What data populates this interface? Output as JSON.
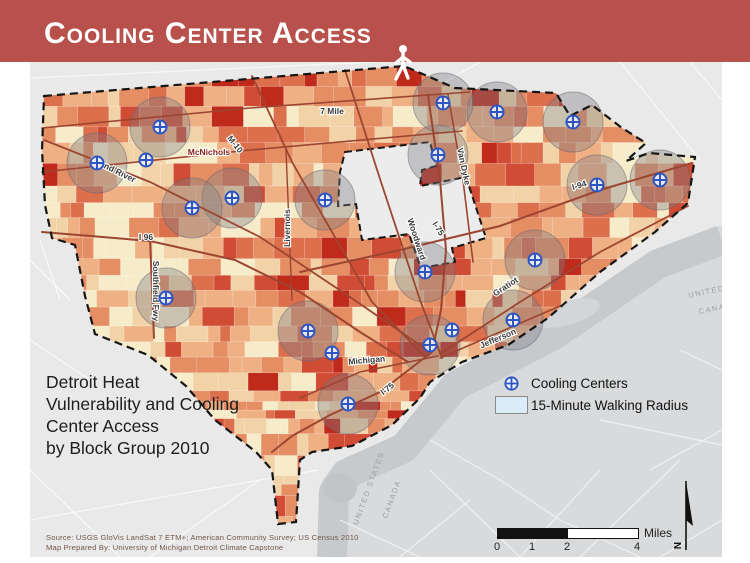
{
  "slide": {
    "title": "Cooling Center Access"
  },
  "map": {
    "title_lines": [
      "Detroit Heat",
      "Vulnerability and Cooling",
      "Center Access",
      "by Block Group 2010"
    ],
    "source_lines": [
      "Source: USGS GloVis LandSat 7 ETM+; American Community Survey; US Census 2010",
      "Map Prepared By: University of Michigan Detroit Climate Capstone"
    ],
    "legend": {
      "items": [
        {
          "symbol": "cooling-center-icon",
          "label": "Cooling  Centers"
        },
        {
          "symbol": "radius-swatch",
          "label": "15-Minute Walking Radius"
        }
      ]
    },
    "scale_bar": {
      "ticks": [
        "0",
        "1",
        "2",
        "4"
      ],
      "unit": "Miles"
    },
    "north_label": "N",
    "street_labels": [
      {
        "t": "7 Mile",
        "x": 332,
        "y": 114,
        "a": 0
      },
      {
        "t": "McNichols",
        "x": 209,
        "y": 155,
        "a": 0,
        "c": "#8a2118"
      },
      {
        "t": "M-10",
        "x": 233,
        "y": 146,
        "a": 52
      },
      {
        "t": "Grand River",
        "x": 112,
        "y": 172,
        "a": 26
      },
      {
        "t": "I 96",
        "x": 146,
        "y": 240,
        "a": 0
      },
      {
        "t": "Southfield Fwy",
        "x": 153,
        "y": 291,
        "a": 90
      },
      {
        "t": "Livernois",
        "x": 290,
        "y": 228,
        "a": -90
      },
      {
        "t": "Woodward",
        "x": 414,
        "y": 240,
        "a": 72
      },
      {
        "t": "Van Dyke",
        "x": 461,
        "y": 167,
        "a": 78
      },
      {
        "t": "I-75",
        "x": 436,
        "y": 230,
        "a": 58
      },
      {
        "t": "I-94",
        "x": 580,
        "y": 188,
        "a": -17
      },
      {
        "t": "Gratiot",
        "x": 507,
        "y": 289,
        "a": -33
      },
      {
        "t": "Jefferson",
        "x": 499,
        "y": 341,
        "a": -23
      },
      {
        "t": "Michigan",
        "x": 367,
        "y": 363,
        "a": -5
      },
      {
        "t": "I-75",
        "x": 389,
        "y": 391,
        "a": -38
      }
    ],
    "border_labels": [
      {
        "t": "UNITED STATES",
        "x": 371,
        "y": 489,
        "a": -70
      },
      {
        "t": "CANADA",
        "x": 394,
        "y": 500,
        "a": -70
      },
      {
        "t": "UNITED S",
        "x": 712,
        "y": 293,
        "a": -12
      },
      {
        "t": "CANADA",
        "x": 719,
        "y": 310,
        "a": -12
      }
    ],
    "cooling_centers": [
      {
        "x": 160,
        "y": 127,
        "r": true
      },
      {
        "x": 97,
        "y": 163,
        "r": true
      },
      {
        "x": 146,
        "y": 160,
        "r": false
      },
      {
        "x": 232,
        "y": 198,
        "r": true
      },
      {
        "x": 192,
        "y": 208,
        "r": true
      },
      {
        "x": 325,
        "y": 200,
        "r": true
      },
      {
        "x": 438,
        "y": 155,
        "r": true
      },
      {
        "x": 443,
        "y": 103,
        "r": true
      },
      {
        "x": 497,
        "y": 112,
        "r": true
      },
      {
        "x": 573,
        "y": 122,
        "r": true
      },
      {
        "x": 660,
        "y": 180,
        "r": true
      },
      {
        "x": 597,
        "y": 185,
        "r": true
      },
      {
        "x": 166,
        "y": 298,
        "r": true
      },
      {
        "x": 308,
        "y": 331,
        "r": true
      },
      {
        "x": 332,
        "y": 353,
        "r": false
      },
      {
        "x": 348,
        "y": 404,
        "r": true
      },
      {
        "x": 430,
        "y": 345,
        "r": true
      },
      {
        "x": 452,
        "y": 330,
        "r": false
      },
      {
        "x": 513,
        "y": 320,
        "r": true
      },
      {
        "x": 425,
        "y": 272,
        "r": true
      },
      {
        "x": 535,
        "y": 260,
        "r": true
      }
    ],
    "colors": {
      "title_bar": "#b8504b",
      "map_bg": "#e9e9e9",
      "canada_land": "#d8dadc",
      "river": "#c7cacd",
      "boundary": "#151515",
      "street": "#9c4632",
      "cooling_center_blue": "#2f55c0",
      "radius_fill": "rgba(125,125,135,0.38)",
      "radius_stroke": "rgba(100,100,112,0.5)",
      "legend_swatch": "#d9ecf7",
      "enclave": "#ececec",
      "palette": [
        "#f7ecca",
        "#f2d3a8",
        "#efb183",
        "#e58e63",
        "#dc6f4c",
        "#d04c34",
        "#c02a1a"
      ]
    }
  }
}
